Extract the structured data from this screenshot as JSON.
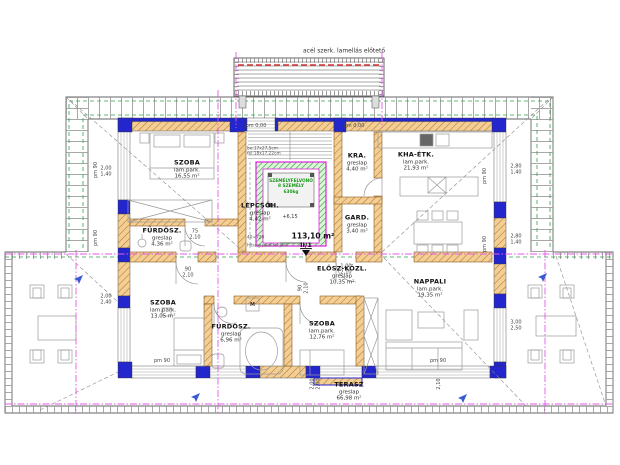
{
  "colors": {
    "wall_blue": "#2326cc",
    "wall_fill": "#f3cf96",
    "wall_hatch": "#b5772c",
    "elevator_green": "#1fa51f",
    "axis_magenta": "#e459e4",
    "roof_green_dash": "#2ea44f",
    "red_dash": "#d03030",
    "drawing_line": "#666666",
    "furniture_line": "#999999"
  },
  "canopy": {
    "label": "acél szerk. lamellás előtető"
  },
  "unit": {
    "area_total": "113,10 m²",
    "unit_no": "II/1",
    "level_mark": "+6,15",
    "floor_level_left": "pm 0,00",
    "floor_level_right": "pm 0,00"
  },
  "elevator": {
    "line1": "SZEMÉLYFELVONÓ",
    "line2": "8 SZEMÉLY",
    "line3": "630kg"
  },
  "stair": {
    "note": "be:17x27,5cm\nfel:18x17,22cm",
    "steps": "40=720",
    "attic_note": "hőszig padl.fel:járó"
  },
  "labels": {
    "washing_machine": "M"
  },
  "rooms": [
    {
      "name": "SZOBA",
      "floor": "lam.park.",
      "area": "16,55 m²"
    },
    {
      "name": "FÜRDŐSZ.",
      "floor": "greslap",
      "area": "4,36 m²"
    },
    {
      "name": "LÉPCSŐH.",
      "floor": "gréslap",
      "area": "4,42 m²"
    },
    {
      "name": "KRA.",
      "floor": "greslap",
      "area": "4,40 m²"
    },
    {
      "name": "GARD.",
      "floor": "greslap",
      "area": "3,40 m²"
    },
    {
      "name": "KHA-ÉTK.",
      "floor": "lam.park.",
      "area": "21,93 m²"
    },
    {
      "name": "SZOBA",
      "floor": "lam.park.",
      "area": "13,05 m²"
    },
    {
      "name": "FÜRDŐSZ.",
      "floor": "greslap",
      "area": "6,96 m²"
    },
    {
      "name": "SZOBA",
      "floor": "lam.park.",
      "area": "12,76 m²"
    },
    {
      "name": "ELŐSZ-KÖZL.",
      "floor": "greslap",
      "area": "10,35 m²"
    },
    {
      "name": "NAPPALI",
      "floor": "lam.park.",
      "area": "19,35 m²"
    },
    {
      "name": "TERASZ",
      "floor": "greslap",
      "area": "66,98 m²"
    }
  ],
  "dims": [
    "2,00\n1,40",
    "2,00\n2,40",
    "2,80\n1,40",
    "2,80\n1,40",
    "3,00\n2,50",
    "90\n2,10",
    "75\n2,10",
    "1,00\n2,10",
    "90\n2,10",
    "pm 90",
    "pm 90",
    "pm 90",
    "pm 90",
    "pm 90",
    "pm 90",
    "2,00\n2,00",
    "2,10"
  ]
}
